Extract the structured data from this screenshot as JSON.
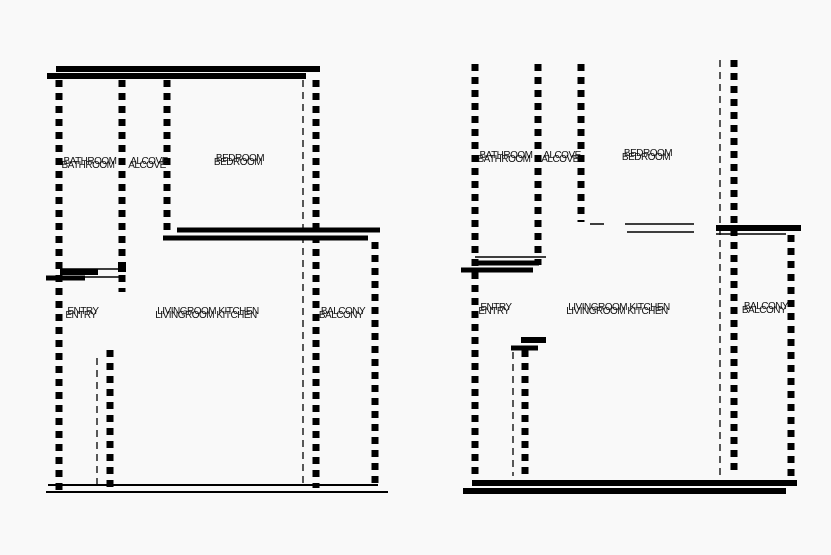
{
  "meta": {
    "description": "Two black-and-white architectural floor plans side by side",
    "background_color": "#f9f9f9",
    "wall_color": "#000000",
    "label_color": "#111111"
  },
  "left_plan": {
    "labels": {
      "bathroom": "BATHROOM",
      "alcove": "ALCOVE",
      "bedroom": "BEDROOM",
      "entry": "ENTRY",
      "living": "LIVINGROOM KITCHEN",
      "balcony": "BALCONY"
    }
  },
  "right_plan": {
    "labels": {
      "bathroom": "BATHROOM",
      "alcove": "ALCOVE",
      "bedroom": "BEDROOM",
      "entry": "ENTRY",
      "living": "LIVINGROOM KITCHEN",
      "balcony": "BALCONY"
    }
  }
}
